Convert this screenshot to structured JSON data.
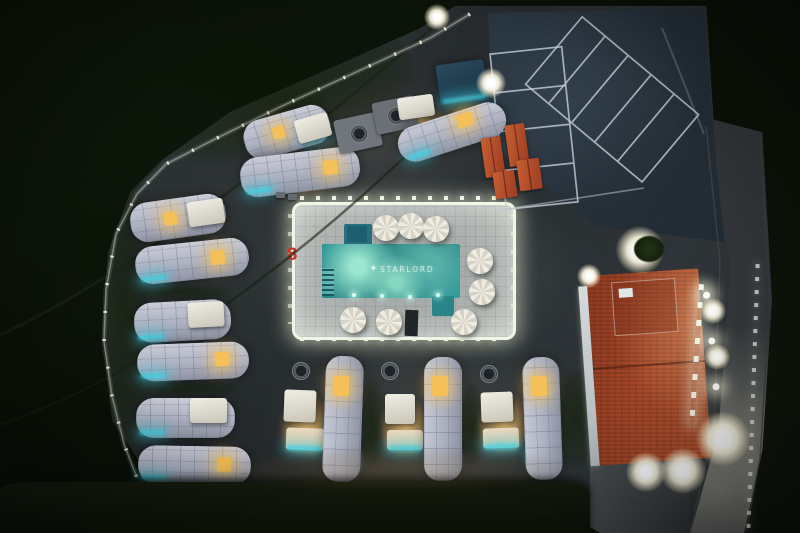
{
  "photo": {
    "pool": {
      "logo_icon": "diamond-star-icon",
      "logo_icon_glyph": "✦",
      "logo_text": "STARLORD"
    },
    "deck_marking": "8",
    "colors": {
      "pool_teal": "#2e9496",
      "pool_bright": "#7fd0bd",
      "led_white": "#f3f6e6",
      "window_amber": "#f5c057",
      "accent_cyan": "#3fd2e6",
      "capsule_roof_grey": "#b0b4c2",
      "roof_terracotta": "#a8492a",
      "canopy_terracotta": "#c75f33",
      "night_pavement": "#292e31",
      "field_green": "#0b1208",
      "marking_red": "#c23b2d"
    }
  }
}
